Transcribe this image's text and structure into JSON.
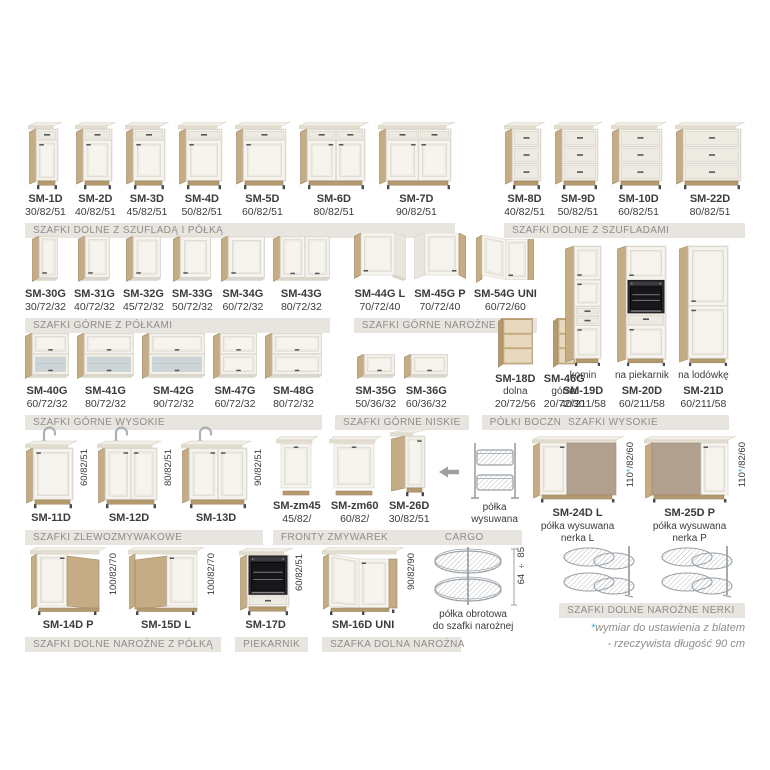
{
  "page": {
    "description": "Kitchen cabinets catalog sheet (Polish)",
    "background": "#ffffff"
  },
  "colors": {
    "wood": "#c6ac84",
    "wood2": "#b59a70",
    "woodl": "#a0855c",
    "front": "#f6f4ef",
    "panel": "#edeae2",
    "line": "#d8d3c8",
    "ctop": "#f1eee6",
    "cedge": "#e5dfd2",
    "cline": "#d5cfc2",
    "glass": "#ccd5d7",
    "blind": "#b2a08e",
    "blindl": "#9c8b79",
    "bar_bg": "#e8e5e0",
    "bar_text": "#8f8d88",
    "text": "#3b3b3b",
    "accent": "#2eb5c8",
    "wire": "#9aa0a5",
    "dark": "#47474b"
  },
  "footnote": {
    "star": "*",
    "line1": "wymiar do ustawienia z blatem",
    "line2": "- rzeczywista długość 90 cm"
  },
  "groups": {
    "r1a": {
      "bar": "SZAFKI DOLNE Z SZUFLADĄ I PÓŁKĄ",
      "items": [
        {
          "code": "SM-1D",
          "dims": "30/82/51",
          "type": "bd1",
          "fw": 22
        },
        {
          "code": "SM-2D",
          "dims": "40/82/51",
          "type": "bd1",
          "fw": 29
        },
        {
          "code": "SM-3D",
          "dims": "45/82/51",
          "type": "bd1",
          "fw": 32
        },
        {
          "code": "SM-4D",
          "dims": "50/82/51",
          "type": "bd1",
          "fw": 36
        },
        {
          "code": "SM-5D",
          "dims": "60/82/51",
          "type": "bd1",
          "fw": 43
        },
        {
          "code": "SM-6D",
          "dims": "80/82/51",
          "type": "bd2",
          "fw": 58
        },
        {
          "code": "SM-7D",
          "dims": "90/82/51",
          "type": "bd2",
          "fw": 65
        }
      ]
    },
    "r1b": {
      "bar": "SZAFKI DOLNE Z SZUFLADAMI",
      "items": [
        {
          "code": "SM-8D",
          "dims": "40/82/51",
          "type": "dr3",
          "fw": 29
        },
        {
          "code": "SM-9D",
          "dims": "50/82/51",
          "type": "dr3",
          "fw": 36
        },
        {
          "code": "SM-10D",
          "dims": "60/82/51",
          "type": "dr3",
          "fw": 43
        },
        {
          "code": "SM-22D",
          "dims": "80/82/51",
          "type": "dr3",
          "fw": 58
        }
      ]
    },
    "r2a": {
      "bar": "SZAFKI GÓRNE Z PÓŁKAMI",
      "items": [
        {
          "code": "SM-30G",
          "dims": "30/72/32",
          "type": "wd1",
          "fw": 19
        },
        {
          "code": "SM-31G",
          "dims": "40/72/32",
          "type": "wd1",
          "fw": 25
        },
        {
          "code": "SM-32G",
          "dims": "45/72/32",
          "type": "wd1",
          "fw": 28
        },
        {
          "code": "SM-33G",
          "dims": "50/72/32",
          "type": "wd1",
          "fw": 31
        },
        {
          "code": "SM-34G",
          "dims": "60/72/32",
          "type": "wd1",
          "fw": 37
        },
        {
          "code": "SM-43G",
          "dims": "80/72/32",
          "type": "wd2",
          "fw": 50
        }
      ]
    },
    "r2b": {
      "bar": "SZAFKI GÓRNE NAROŻNE",
      "items": [
        {
          "code": "SM-44G L",
          "dims": "70/72/40",
          "type": "cwL"
        },
        {
          "code": "SM-45G P",
          "dims": "70/72/40",
          "type": "cwP"
        },
        {
          "code": "SM-54G UNI",
          "dims": "60/72/60",
          "type": "cwU"
        }
      ]
    },
    "tall": {
      "bar": "SZAFKI WYSOKIE",
      "items": [
        {
          "code": "SM-19D",
          "sub": "komin",
          "sub_pos": "above",
          "dims": "40/211/58",
          "type": "tallA",
          "fw": 27
        },
        {
          "code": "SM-20D",
          "sub": "na piekarnik",
          "sub_pos": "above",
          "dims": "60/211/58",
          "type": "tallB",
          "fw": 40
        },
        {
          "code": "SM-21D",
          "sub": "na lodówkę",
          "sub_pos": "above",
          "dims": "60/211/58",
          "type": "tallC",
          "fw": 40
        }
      ]
    },
    "r3a": {
      "bar": "SZAFKI GÓRNE WYSOKIE",
      "items": [
        {
          "code": "SM-40G",
          "dims": "60/72/32",
          "type": "fgl",
          "fw": 37
        },
        {
          "code": "SM-41G",
          "dims": "80/72/32",
          "type": "fgl",
          "fw": 50
        },
        {
          "code": "SM-42G",
          "dims": "90/72/32",
          "type": "fgl",
          "fw": 56
        },
        {
          "code": "SM-47G",
          "dims": "60/72/32",
          "type": "f2",
          "fw": 37
        },
        {
          "code": "SM-48G",
          "dims": "80/72/32",
          "type": "f2",
          "fw": 50
        }
      ]
    },
    "r3b": {
      "bar": "SZAFKI GÓRNE NISKIE",
      "items": [
        {
          "code": "SM-35G",
          "dims": "50/36/32",
          "type": "f1",
          "fw": 31
        },
        {
          "code": "SM-36G",
          "dims": "60/36/32",
          "type": "f1",
          "fw": 37
        }
      ]
    },
    "r3c": {
      "bar": "PÓŁKI BOCZNE UNI",
      "items": [
        {
          "code": "SM-18D",
          "sub": "dolna",
          "sub_pos": "mid",
          "dims": "20/72/56",
          "type": "shelf",
          "fw": 30
        },
        {
          "code": "SM-46G",
          "sub": "górna",
          "sub_pos": "mid",
          "dims": "20/72/30",
          "type": "shelf",
          "fw": 17
        }
      ]
    },
    "r4a": {
      "bar": "SZAFKI ZLEWOZMYWAKOWE",
      "items": [
        {
          "code": "SM-11D",
          "vdim": "60/82/51",
          "vtop": 28,
          "type": "sink1",
          "fw": 40
        },
        {
          "code": "SM-12D",
          "vdim": "80/82/51",
          "vtop": 28,
          "type": "sink2",
          "fw": 52
        },
        {
          "code": "SM-13D",
          "vdim": "90/82/51",
          "vtop": 28,
          "type": "sink2",
          "fw": 58
        }
      ]
    },
    "r4bc": {
      "bar": "FRONTY ZMYWAREK",
      "bar2": "CARGO",
      "items": [
        {
          "code": "SM-zm45",
          "dims": "45/82/",
          "type": "dwf",
          "fw": 30
        },
        {
          "code": "SM-zm60",
          "dims": "60/82/",
          "type": "dwf",
          "fw": 40
        },
        {
          "code": "SM-26D",
          "dims": "30/82/51",
          "type": "cargo"
        },
        {
          "type": "arrow"
        },
        {
          "sub": "półka\nwysuwana",
          "type": "figCargo"
        }
      ]
    },
    "r4d": {
      "items": [
        {
          "code": "SM-24D L",
          "sub": "półka wysuwana\nnerka L",
          "vdim": "110*/82/60",
          "type": "nerL"
        },
        {
          "code": "SM-25D P",
          "sub": "półka wysuwana\nnerka P",
          "vdim": "110*/82/60",
          "type": "nerP"
        }
      ]
    },
    "r5a": {
      "bar": "SZAFKI DOLNE NAROŻNE Z PÓŁKĄ",
      "items": [
        {
          "code": "SM-14D P",
          "vdim": "100/82/70",
          "type": "cbP"
        },
        {
          "code": "SM-15D L",
          "vdim": "100/82/70",
          "type": "cbL"
        }
      ]
    },
    "r5b": {
      "bar": "PIEKARNIK",
      "items": [
        {
          "code": "SM-17D",
          "vdim": "60/82/51",
          "type": "ovenH",
          "fw": 42
        }
      ]
    },
    "r5c": {
      "bar": "SZAFKA DOLNA NAROŻNA",
      "bar_w": "66%",
      "items": [
        {
          "code": "SM-16D UNI",
          "vdim": "90/82/90",
          "type": "uniB"
        },
        {
          "sub": "półka obrotowa\ndo szafki narożnej",
          "vdim": "64 ÷ 85",
          "vtop": 2,
          "vright": -6,
          "type": "figCarousel"
        }
      ]
    },
    "r5d": {
      "bar": "SZAFKI DOLNE NAROŻNE NERKI",
      "items": [
        {
          "type": "figNerka"
        },
        {
          "type": "figNerka"
        }
      ]
    }
  }
}
